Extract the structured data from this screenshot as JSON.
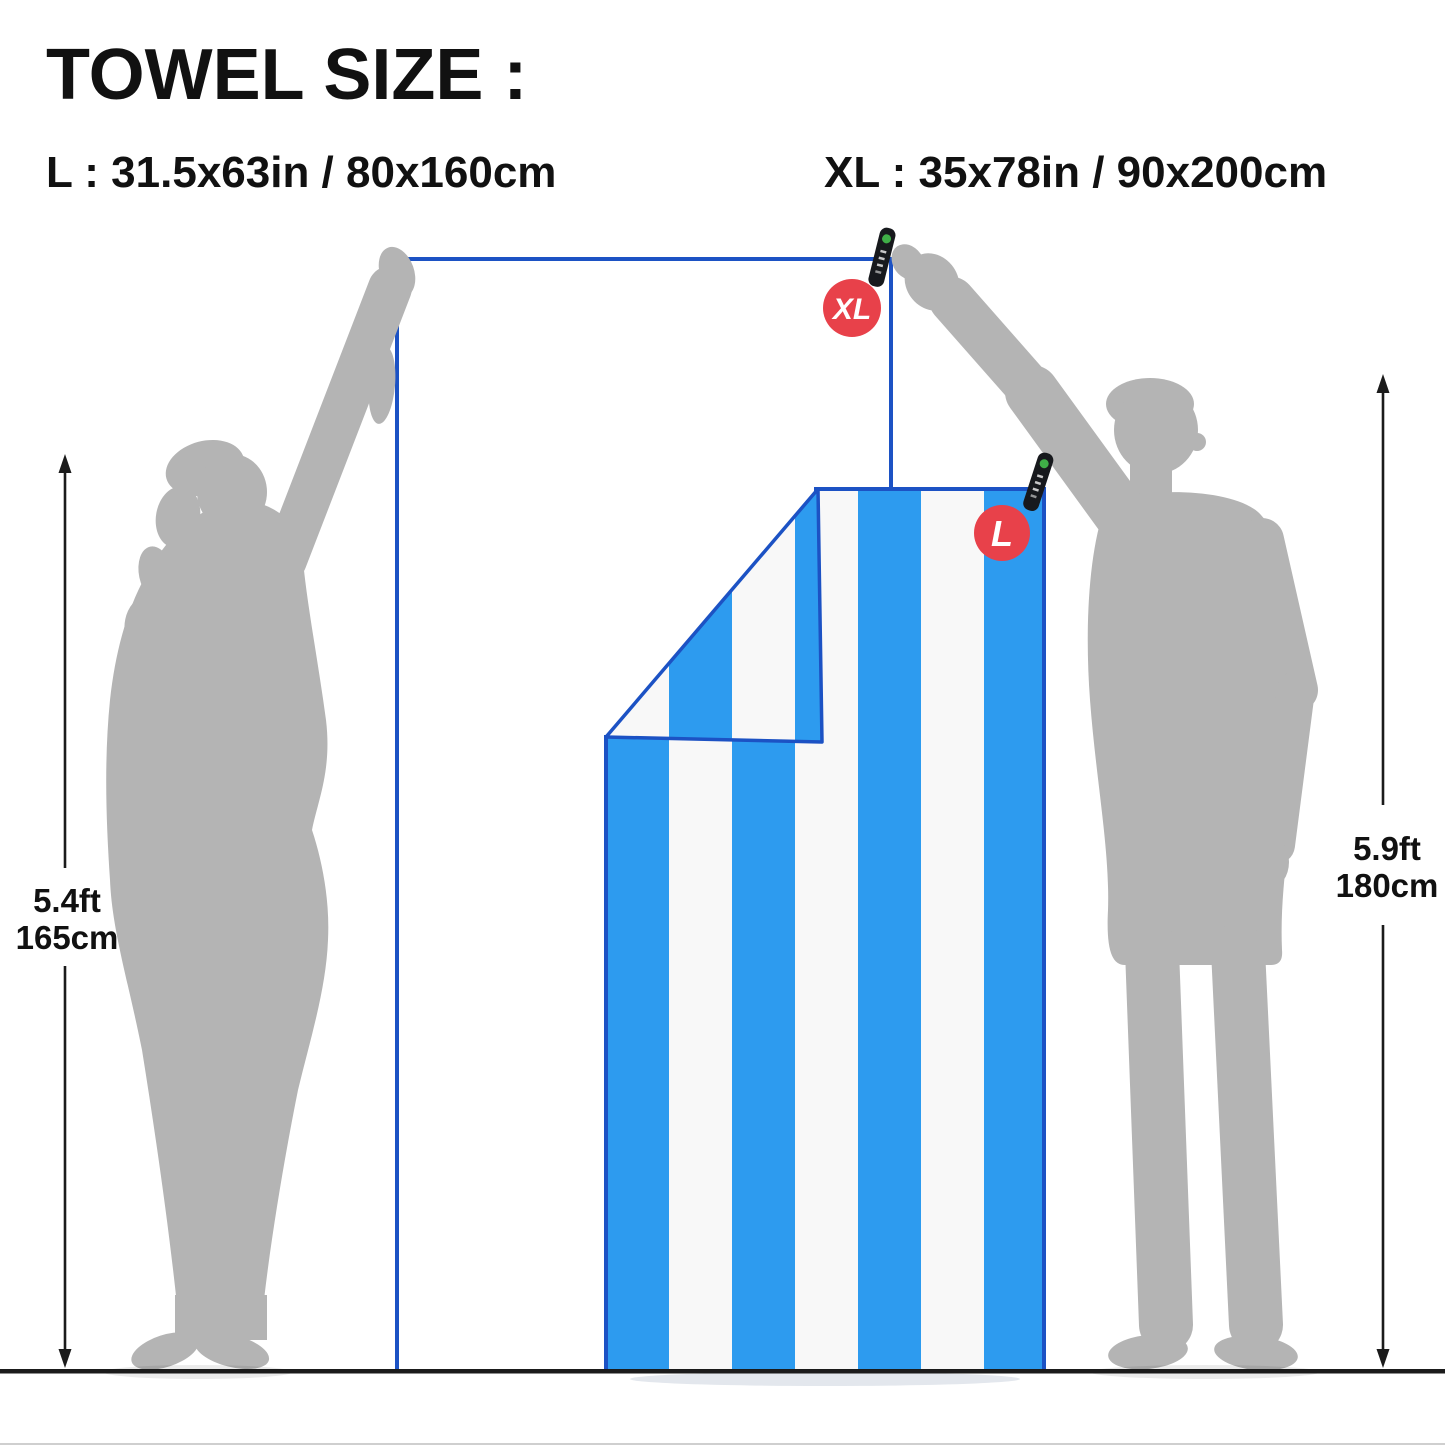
{
  "title": "TOWEL SIZE :",
  "size_labels": {
    "l": "L : 31.5x63in / 80x160cm",
    "xl": "XL : 35x78in / 90x200cm"
  },
  "towels": {
    "xl": {
      "badge": "XL",
      "stripe_count": 7,
      "stripe_orientation": "vertical"
    },
    "l": {
      "badge": "L",
      "stripe_count": 7,
      "stripe_orientation": "vertical",
      "corner": "folded"
    }
  },
  "people": {
    "left": {
      "height_ft": "5.4ft",
      "height_cm": "165cm"
    },
    "right": {
      "height_ft": "5.9ft",
      "height_cm": "180cm"
    }
  },
  "icons": {
    "xl_hang_tag": "hang-tag-icon",
    "l_hang_tag": "hang-tag-icon",
    "left_height_arrow": "vertical-double-arrow-icon",
    "right_height_arrow": "vertical-double-arrow-icon"
  },
  "colors": {
    "stripe_blue": "#2D9BEF",
    "stripe_white": "#F8F8F8",
    "towel_piping": "#1C52C4",
    "badge_red": "#E8414A",
    "silhouette_gray": "#B4B4B4",
    "line_black": "#1B1B1B",
    "text_black": "#111111",
    "tag_black": "#17191D",
    "tag_green": "#3FAE47",
    "background": "#FFFFFF"
  }
}
